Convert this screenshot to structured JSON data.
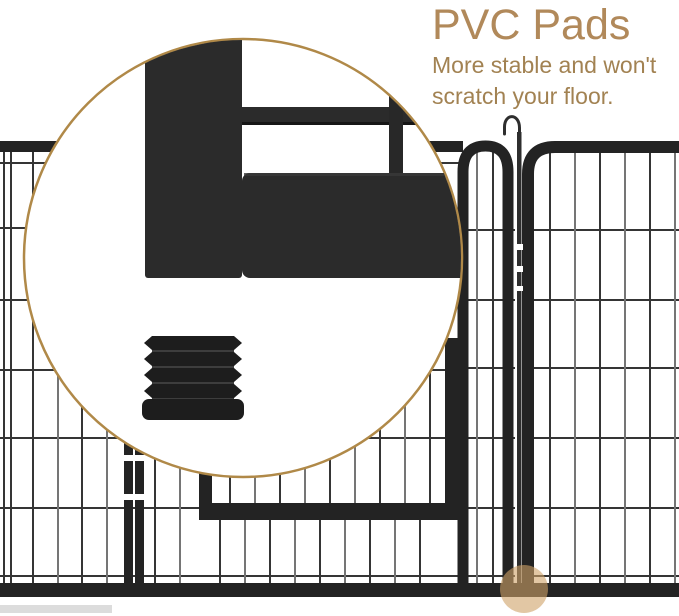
{
  "annotation": {
    "title": "PVC Pads",
    "subtitle_line1": "More stable and won't",
    "subtitle_line2": "scratch your floor."
  },
  "callout": {
    "magnified_feature": "pvc-pad-foot-of-metal-playpen-frame",
    "highlight_marker": "pad-location-dot"
  },
  "colors": {
    "fence-frame": "#232323",
    "wire-dark": "#353535",
    "wire-light": "#757575",
    "zoom-part": "#2b2b2b",
    "pad-black": "#1d1d1d",
    "pad-groove": "#3d3d3d",
    "ring": "#b08948",
    "dot": "#cfa267",
    "title": "#b1895a",
    "subtitle": "#a28252"
  }
}
